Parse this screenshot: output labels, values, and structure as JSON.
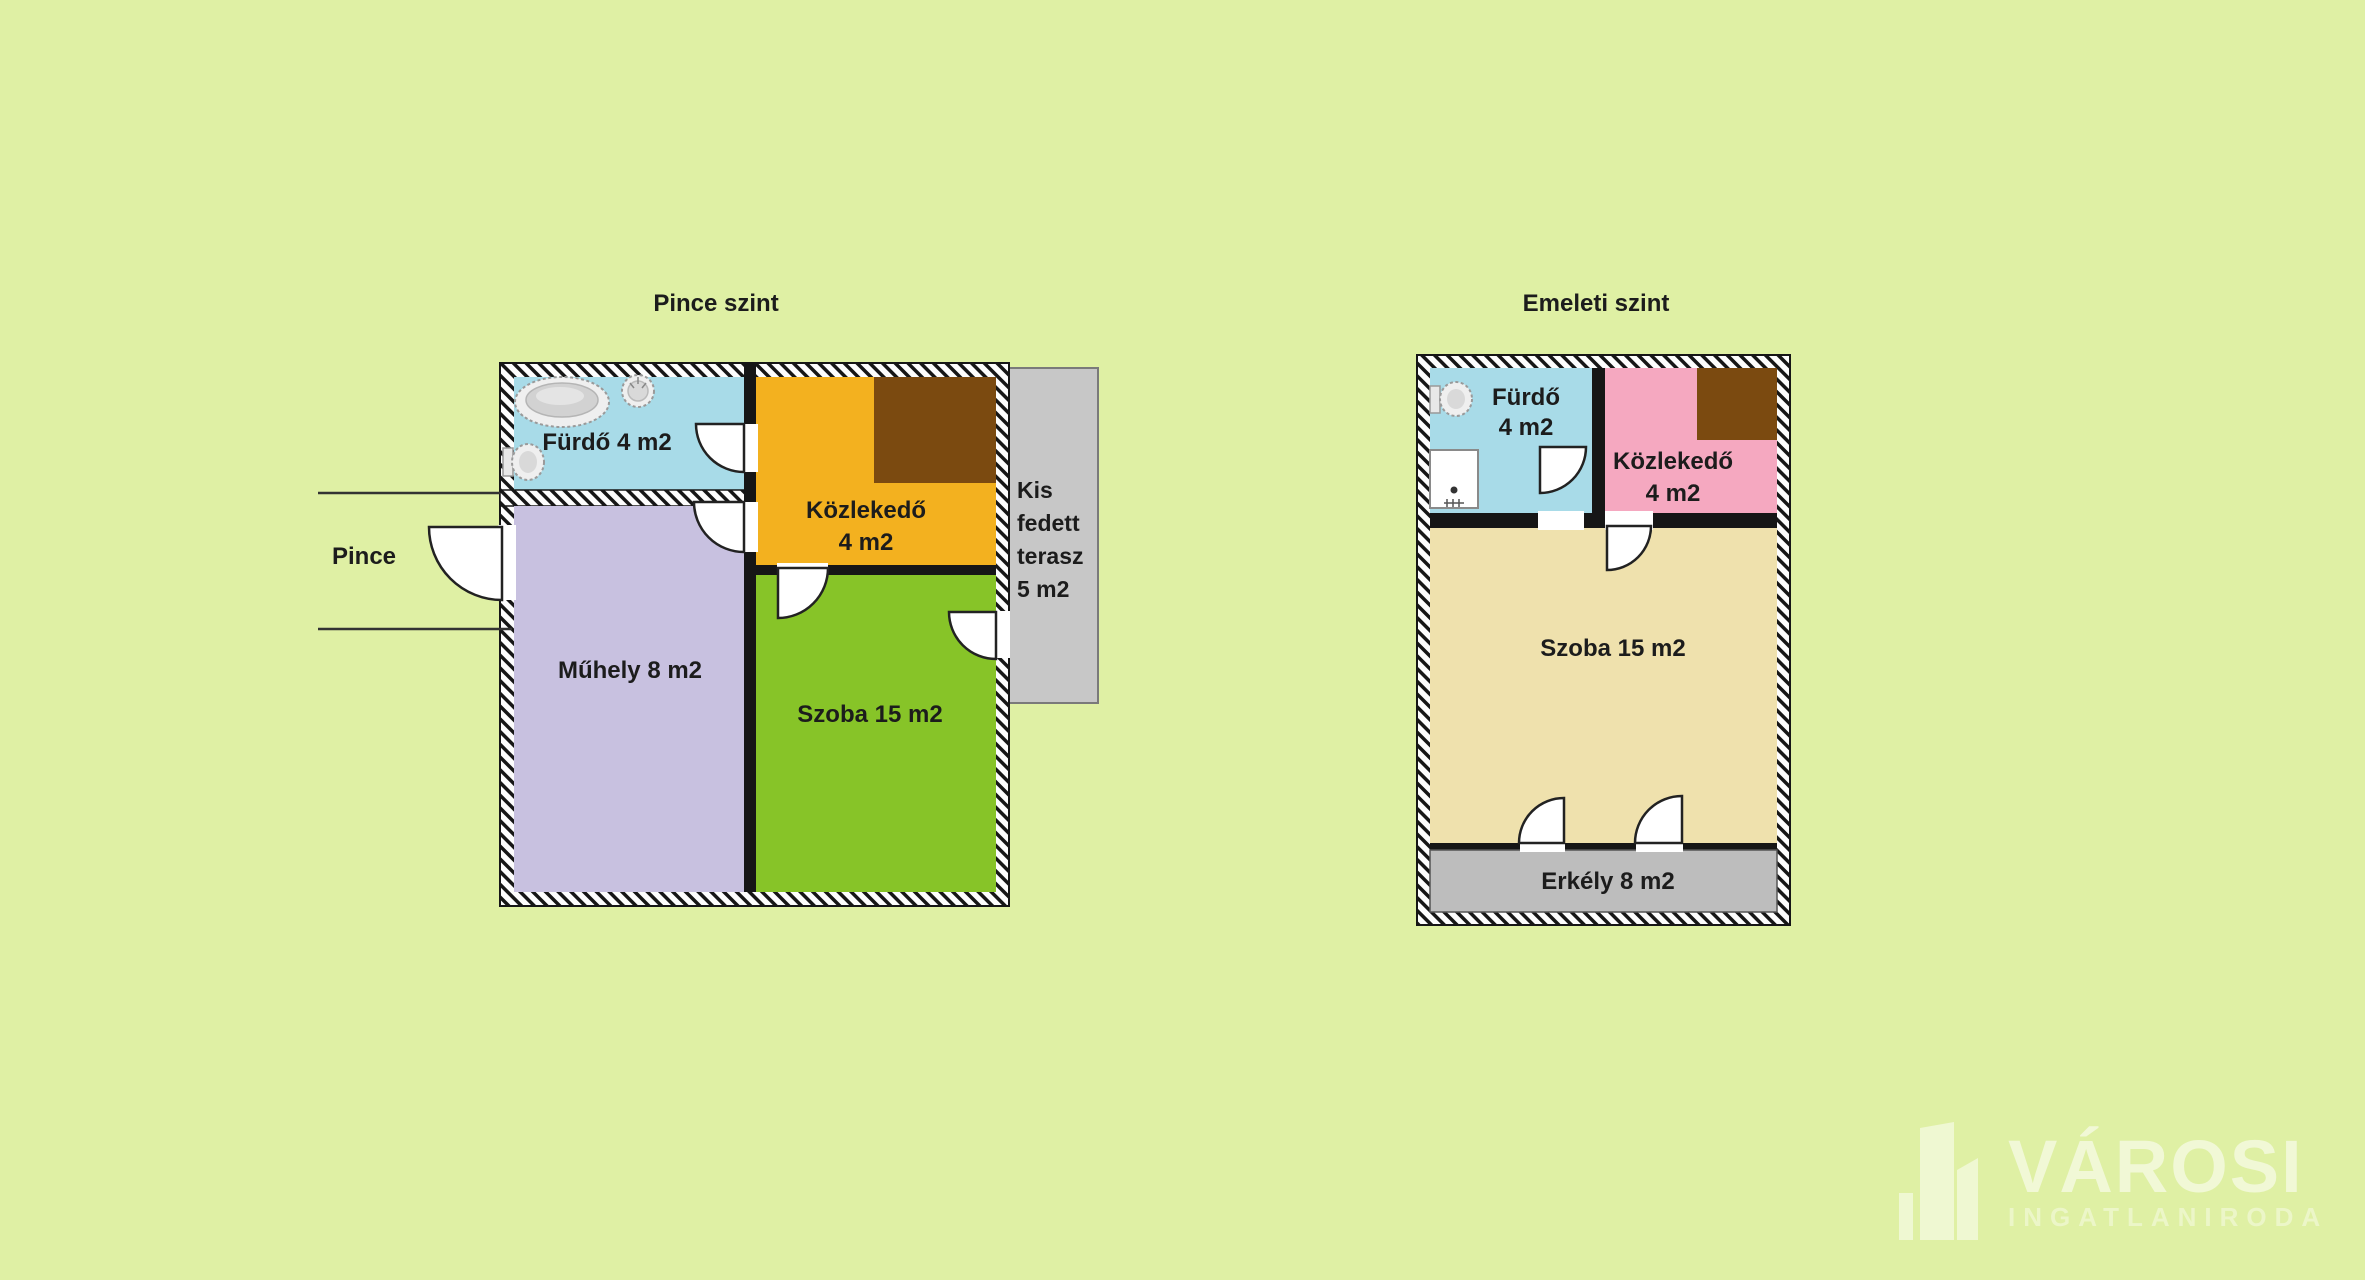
{
  "background_color": "#dff0a4",
  "basement": {
    "title": "Pince szint",
    "entrance_label": "Pince",
    "bathroom": {
      "label": "Fürdő 4 m2",
      "color": "#a8dbe8"
    },
    "hallway": {
      "label": "Közlekedő",
      "area": "4 m2",
      "color": "#f3b11f"
    },
    "stairs_color": "#7b4a10",
    "workshop": {
      "label": "Műhely 8 m2",
      "color": "#c8c1e0"
    },
    "room": {
      "label": "Szoba 15 m2",
      "color": "#87c428"
    },
    "terrace": {
      "line1": "Kis",
      "line2": "fedett",
      "line3": "terasz",
      "line4": "5 m2",
      "color": "#c7c7c7"
    }
  },
  "upper": {
    "title": "Emeleti szint",
    "bathroom": {
      "label": "Fürdő",
      "area": "4 m2",
      "color": "#a8dbe8"
    },
    "hallway": {
      "label": "Közlekedő",
      "area": "4 m2",
      "color": "#f5a8c0"
    },
    "stairs_color": "#7b4a10",
    "room": {
      "label": "Szoba 15 m2",
      "color": "#efe1ad"
    },
    "balcony": {
      "label": "Erkély 8 m2",
      "color": "#bdbdbd"
    }
  },
  "watermark": {
    "brand": "VÁROSI",
    "subtitle": "INGATLANIRODA"
  }
}
